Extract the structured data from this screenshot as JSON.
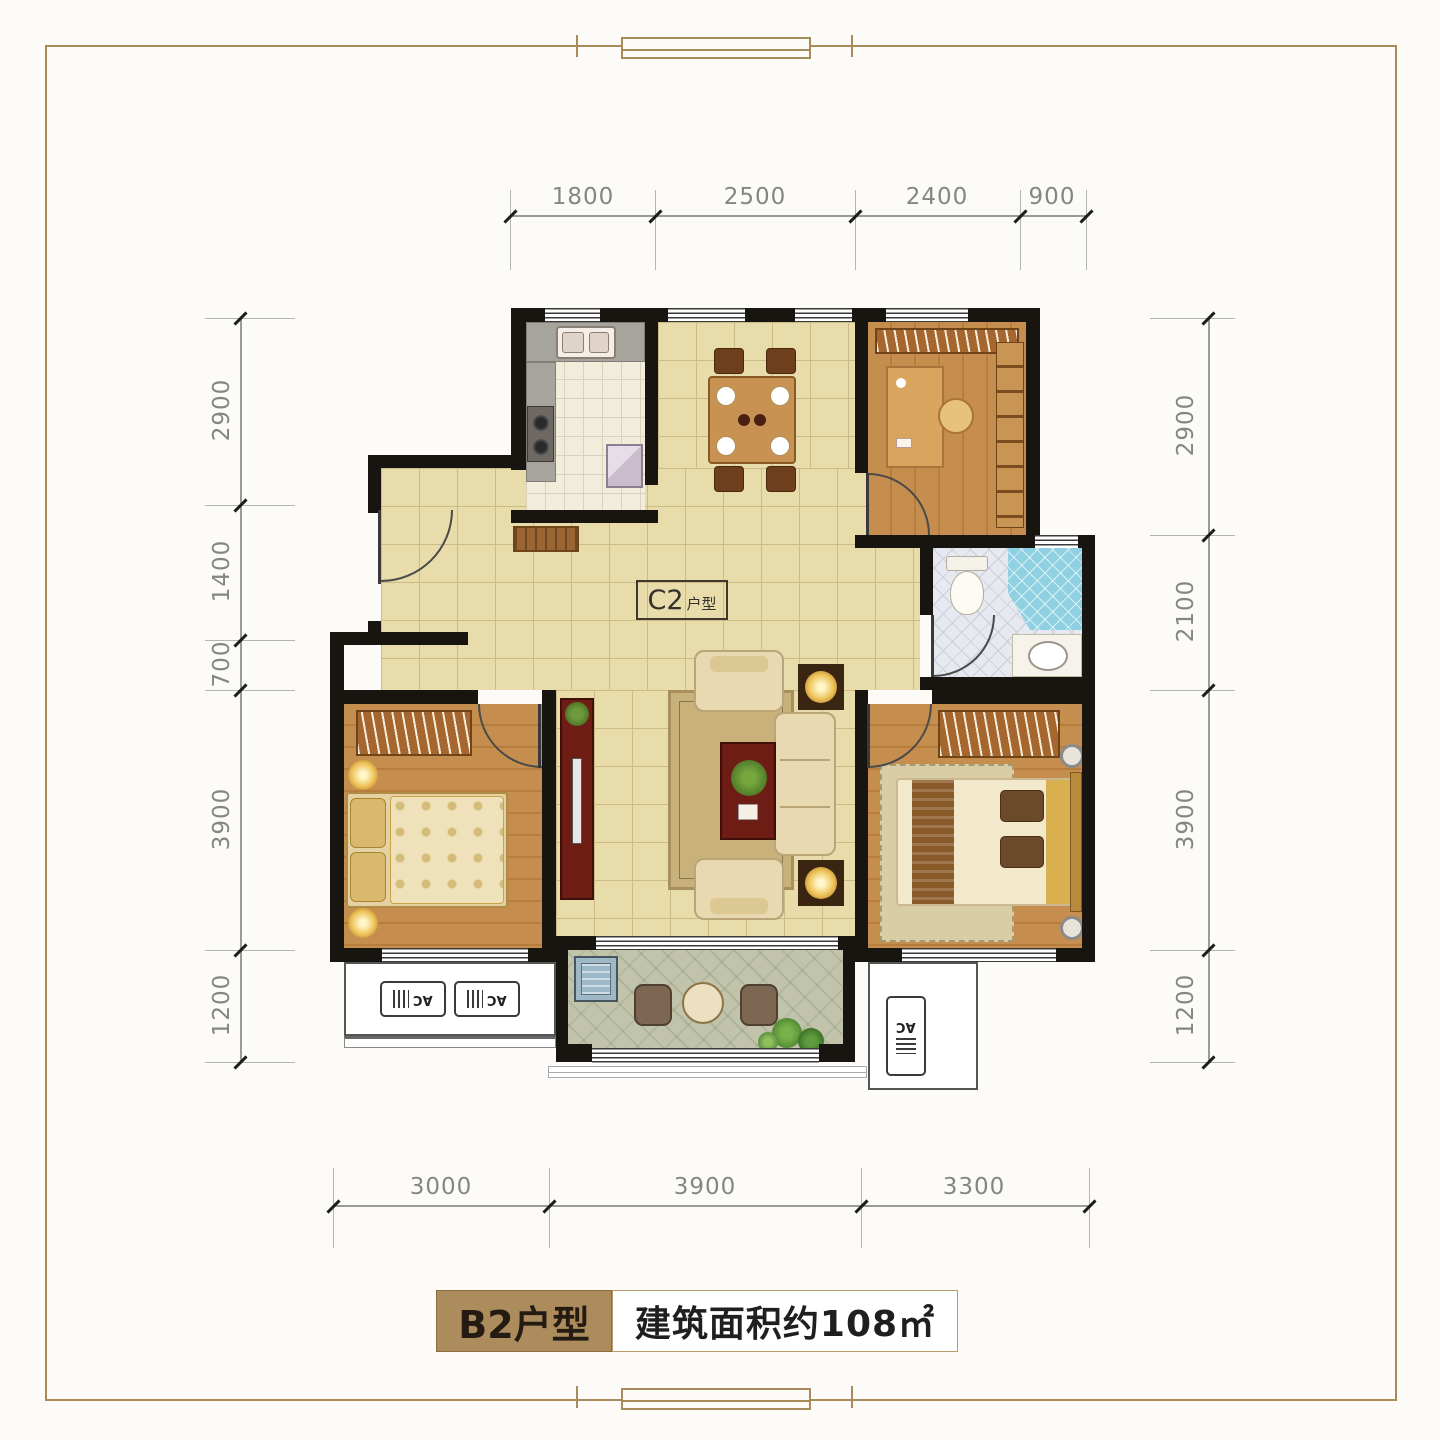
{
  "frame": {
    "color": "#a98a5a"
  },
  "floor_plan": {
    "unit_label": {
      "main": "C2",
      "sub": "户型"
    },
    "ac_label": "AC",
    "colors": {
      "wall": "#181511",
      "marble_floor": "#e9dcab",
      "wood_floor": "#c68e4e",
      "kitchen_tile": "#f2ecda",
      "bathroom_tile": "#e6e9ef",
      "shower_blue": "#8fd0e2",
      "balcony_stone": "#c1c4ab"
    }
  },
  "dimensions": {
    "top": [
      "1800",
      "2500",
      "2400",
      "900"
    ],
    "left": [
      "2900",
      "1400",
      "700",
      "3900",
      "1200"
    ],
    "right": [
      "2900",
      "2100",
      "3900",
      "1200"
    ],
    "bottom": [
      "3000",
      "3900",
      "3300"
    ]
  },
  "title_bar": {
    "unit_name": "B2户型",
    "area_text": "建筑面积约108㎡",
    "accent_color": "#ac8b5d"
  }
}
